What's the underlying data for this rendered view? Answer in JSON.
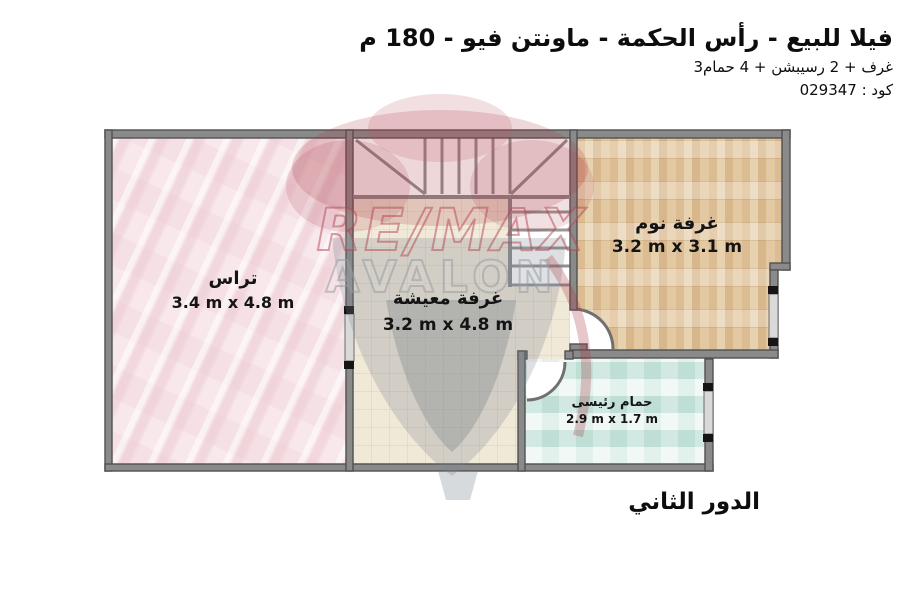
{
  "header": {
    "title": "فيلا للبيع - رأس الحكمة - ماونتن فيو - 180 م",
    "subtitle": "3غرف + 2 رسيبشن + 4 حمام",
    "code": "كود : 029347"
  },
  "rooms": {
    "terrace": {
      "name": "تراس",
      "dims": "3.4 m x 4.8 m"
    },
    "living": {
      "name": "غرفة معيشة",
      "dims": "3.2 m x 4.8 m"
    },
    "bedroom": {
      "name": "غرفة نوم",
      "dims": "3.2 m x 3.1 m"
    },
    "bathroom": {
      "name": "حمام رئيسى",
      "dims": "2.9 m x 1.7 m"
    }
  },
  "footer": {
    "floor_label": "الدور الثاني"
  },
  "watermark": {
    "brand": "RE/MAX",
    "sub": "AVALON"
  },
  "colors": {
    "wall": "#8a8a8a",
    "wall_edge": "#515151",
    "terrace_floor": "#f6e4e8",
    "living_floor": "#f1e9d8",
    "bedroom_floor": "#ddbe94",
    "bathroom_floor": "#d9ece7",
    "watermark_red": "#b14a58",
    "watermark_gray": "#9aa2aa"
  }
}
